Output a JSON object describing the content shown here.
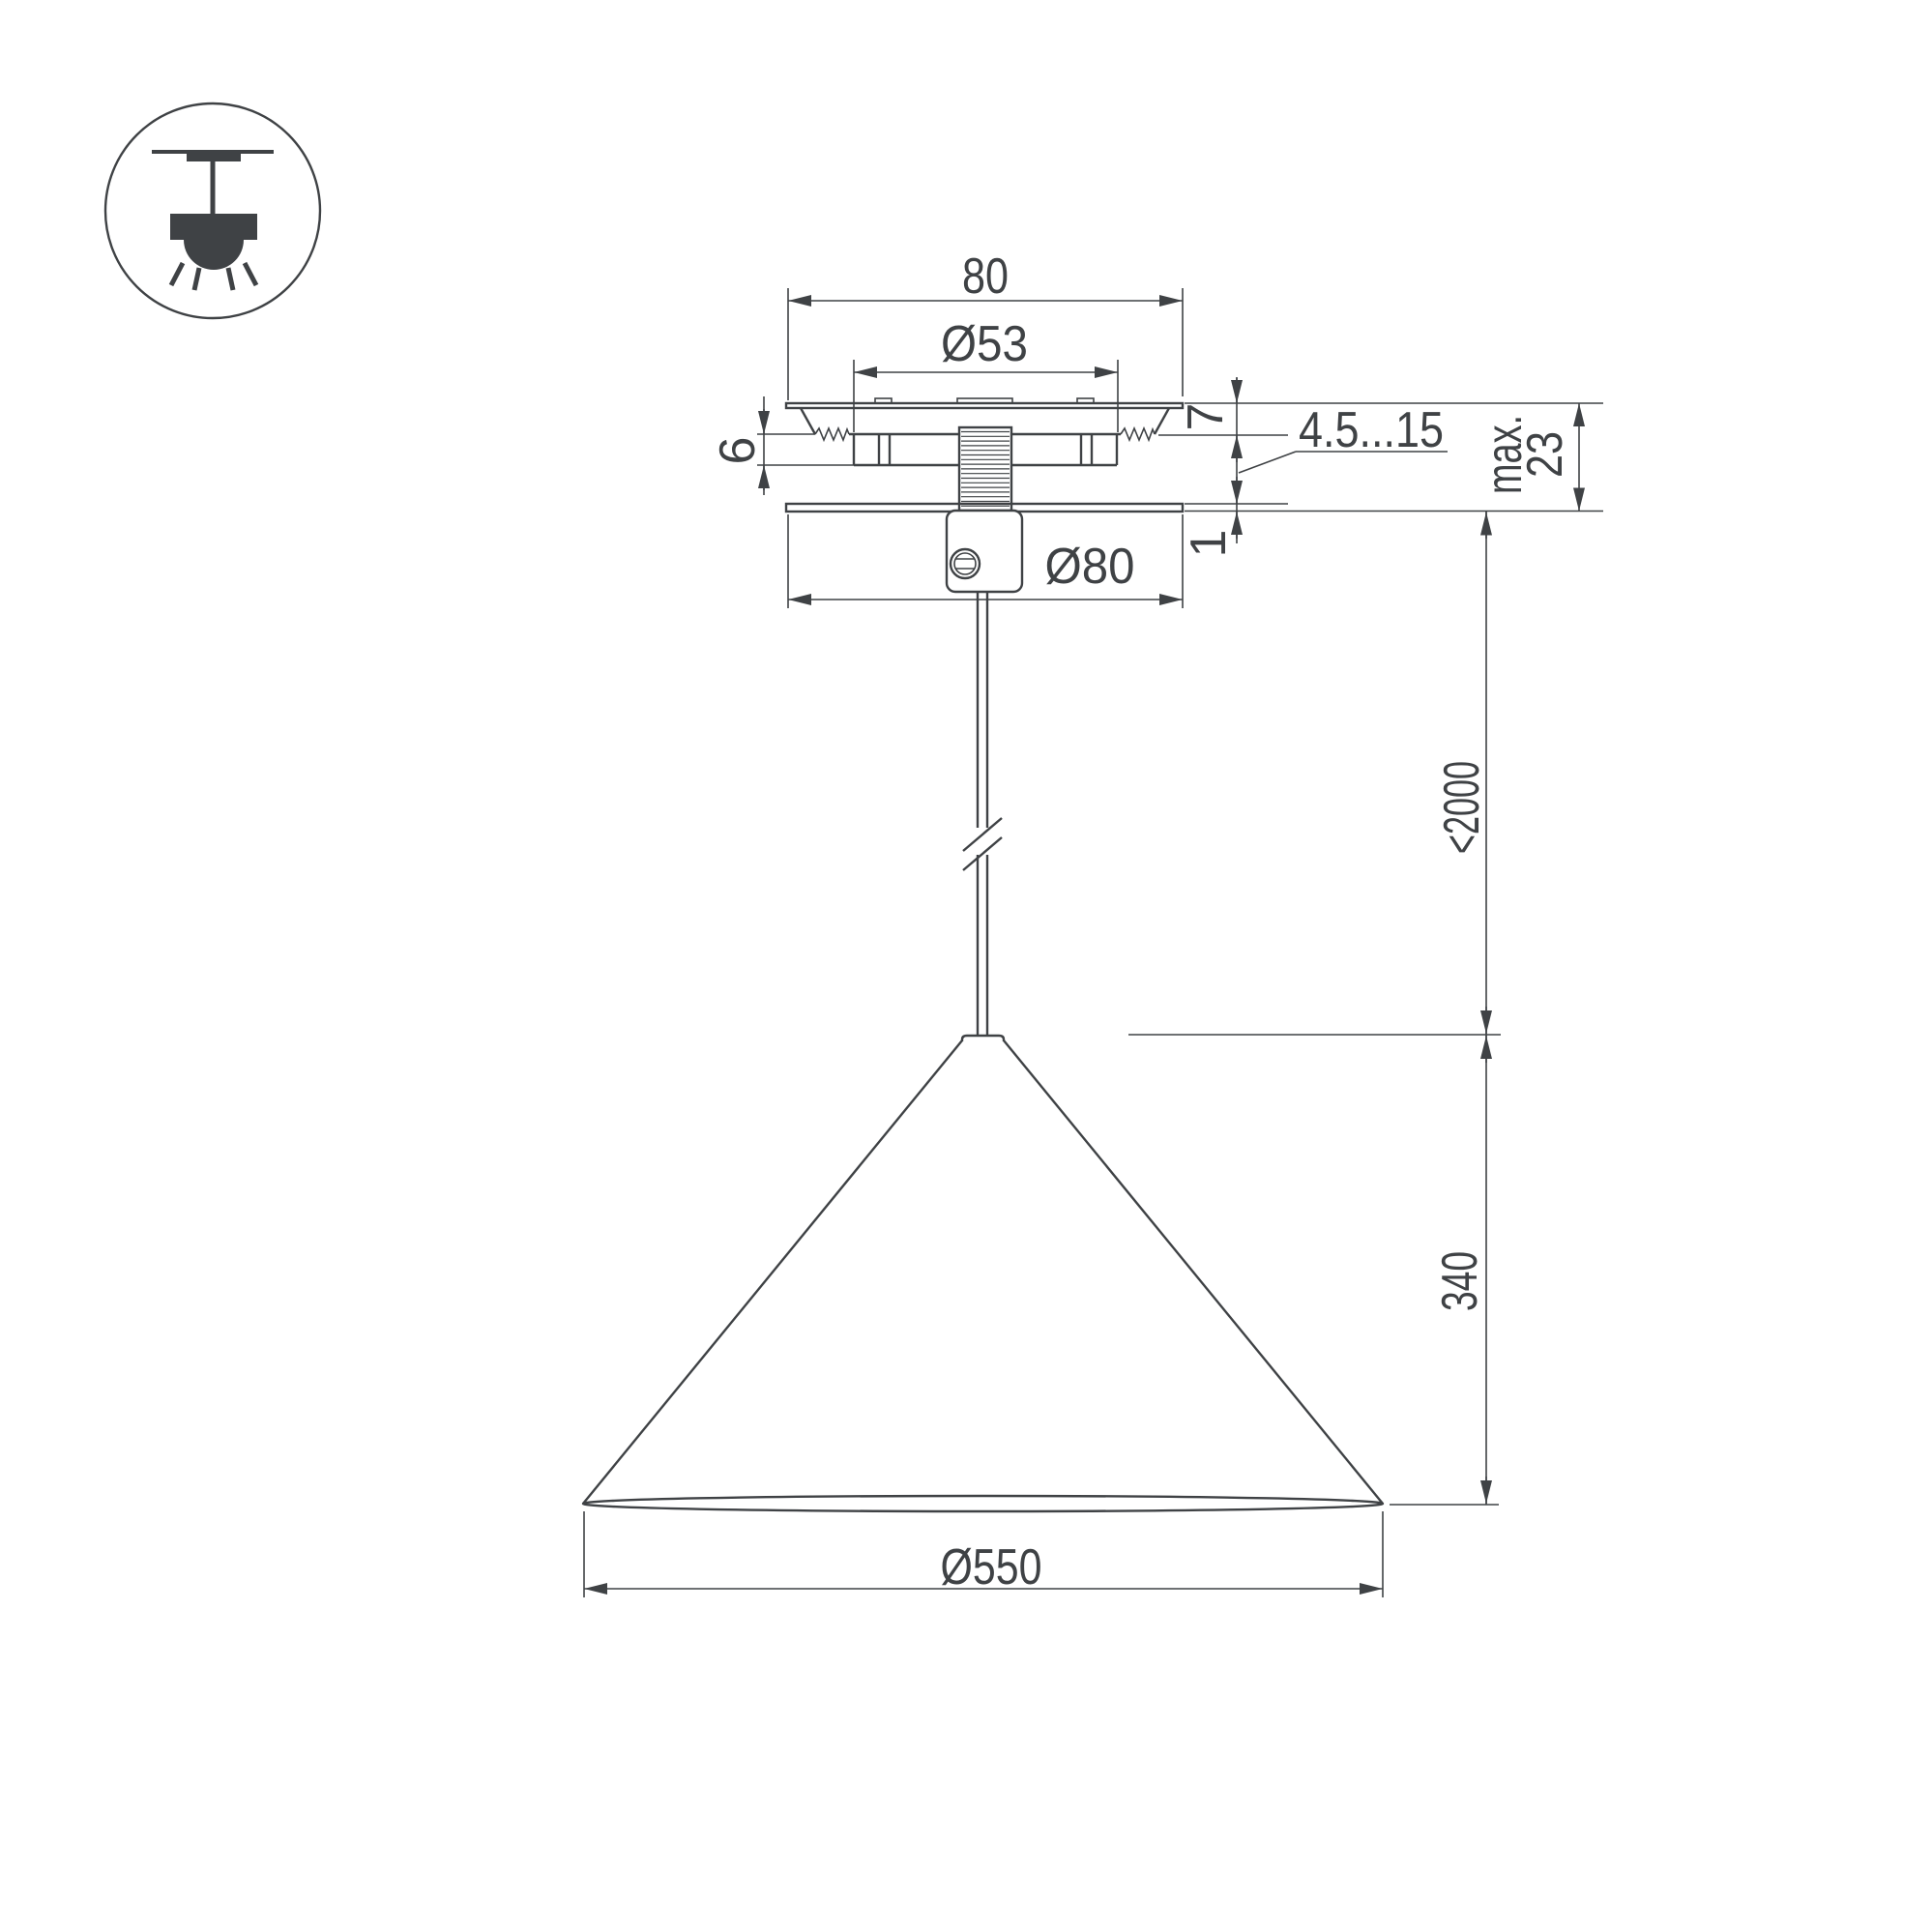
{
  "page": {
    "background": "#ffffff",
    "line_color": "#3f4245"
  },
  "icon": {
    "name": "pendant-lamp-icon"
  },
  "dimensions": {
    "canopy_plate_width": "80",
    "mount_hole_diameter": "Ø53",
    "flange_thickness": "7",
    "bracket_height": "6",
    "ceiling_thickness_range": "4.5...15",
    "max_label": "max.",
    "max_value": "23",
    "cover_plate_thickness": "1",
    "canopy_diameter": "Ø80",
    "suspension_length": "<2000",
    "shade_height": "340",
    "shade_diameter": "Ø550"
  }
}
